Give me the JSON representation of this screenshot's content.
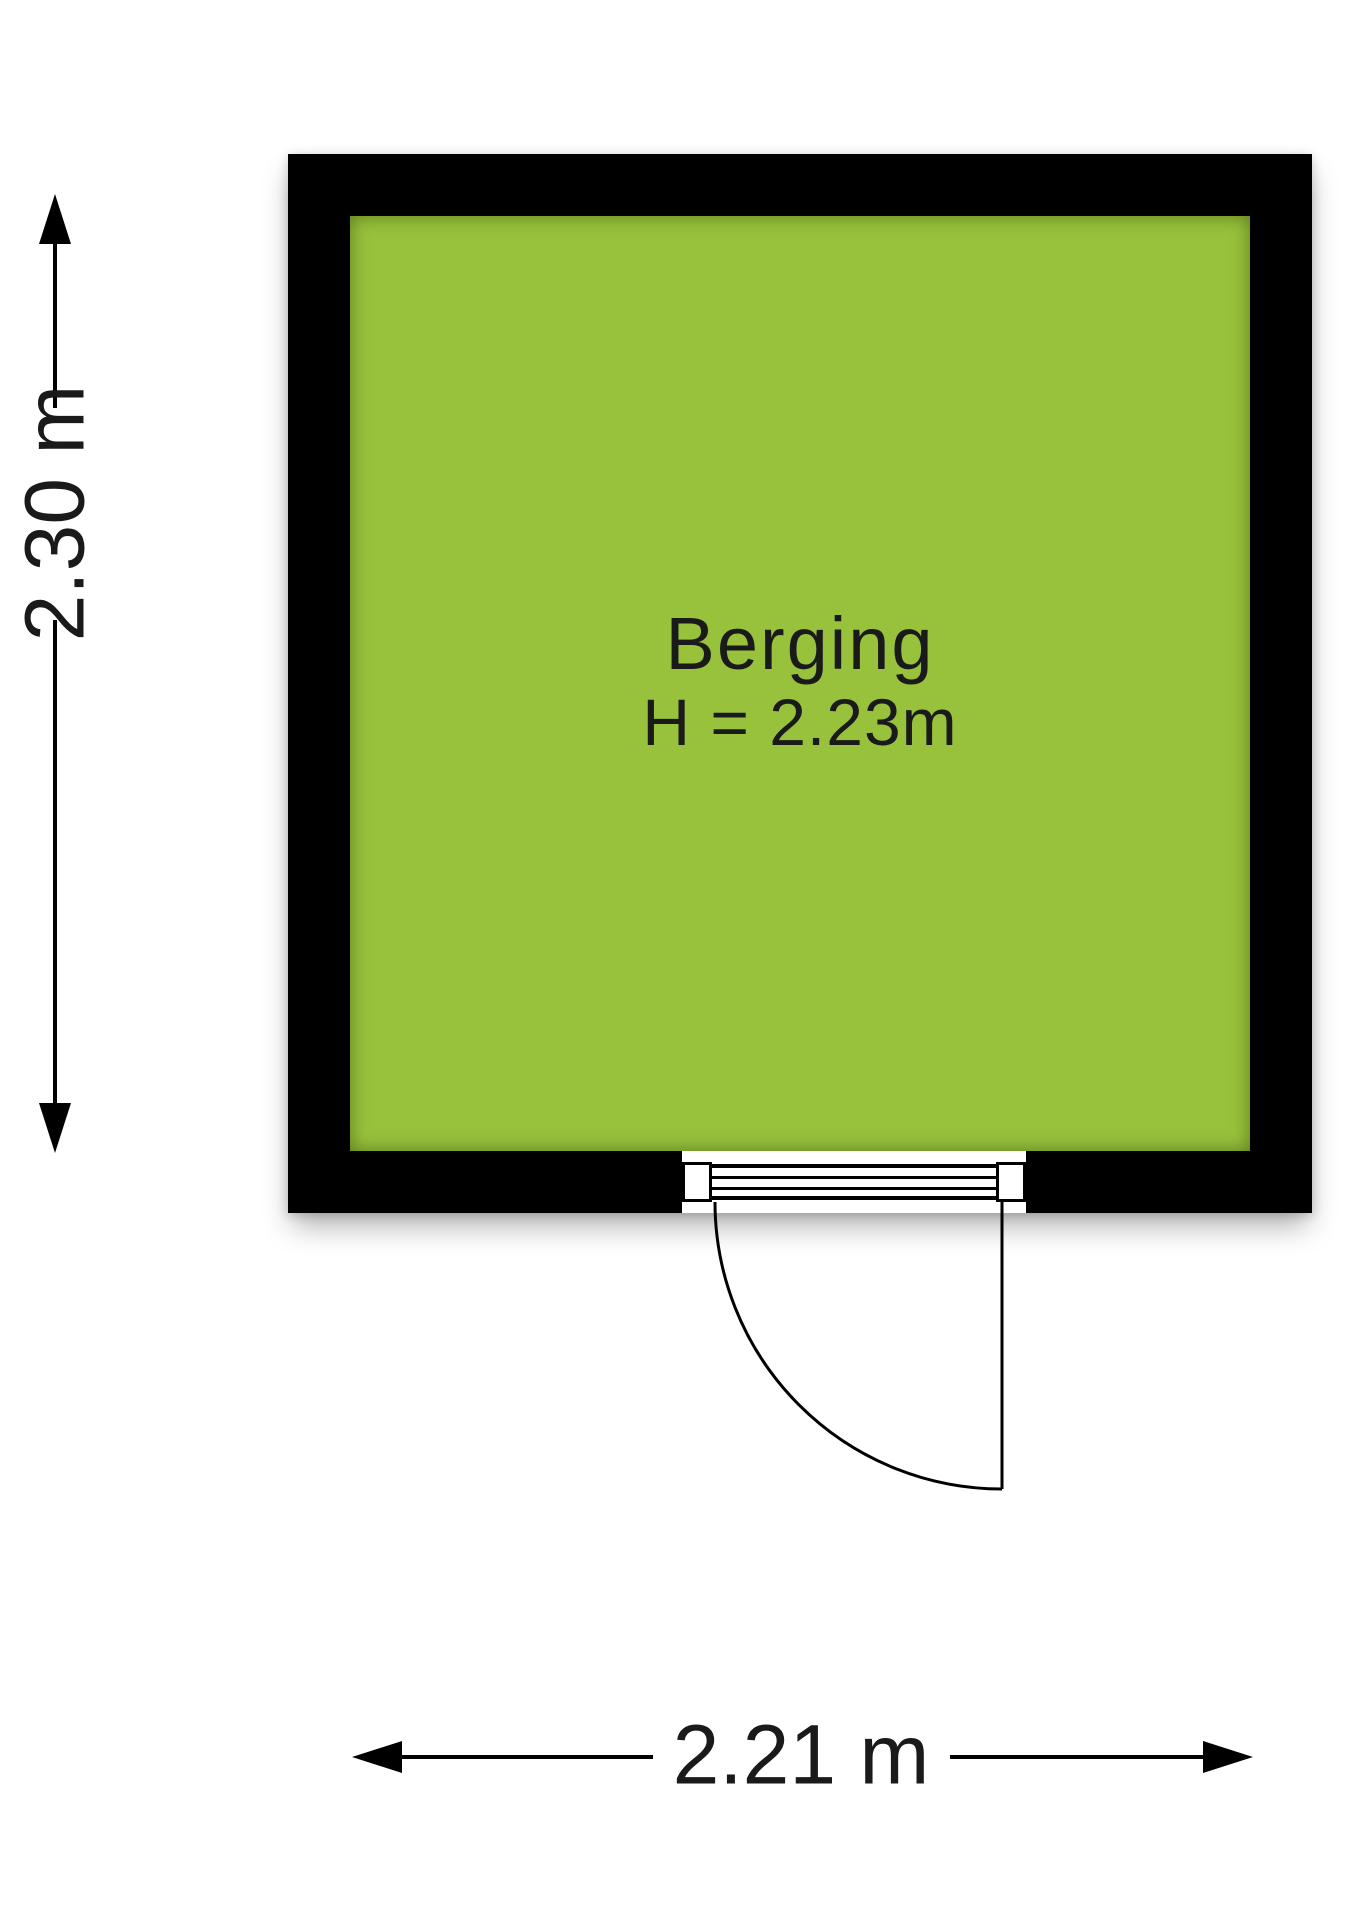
{
  "floorplan": {
    "room": {
      "name": "Berging",
      "height_label": "H = 2.23m"
    },
    "dimensions": {
      "vertical_label": "2.30 m",
      "horizontal_label": "2.21 m"
    },
    "colors": {
      "floor": "#98c23c",
      "wall": "#000000",
      "text": "#1a1a1a",
      "background": "#ffffff"
    }
  }
}
